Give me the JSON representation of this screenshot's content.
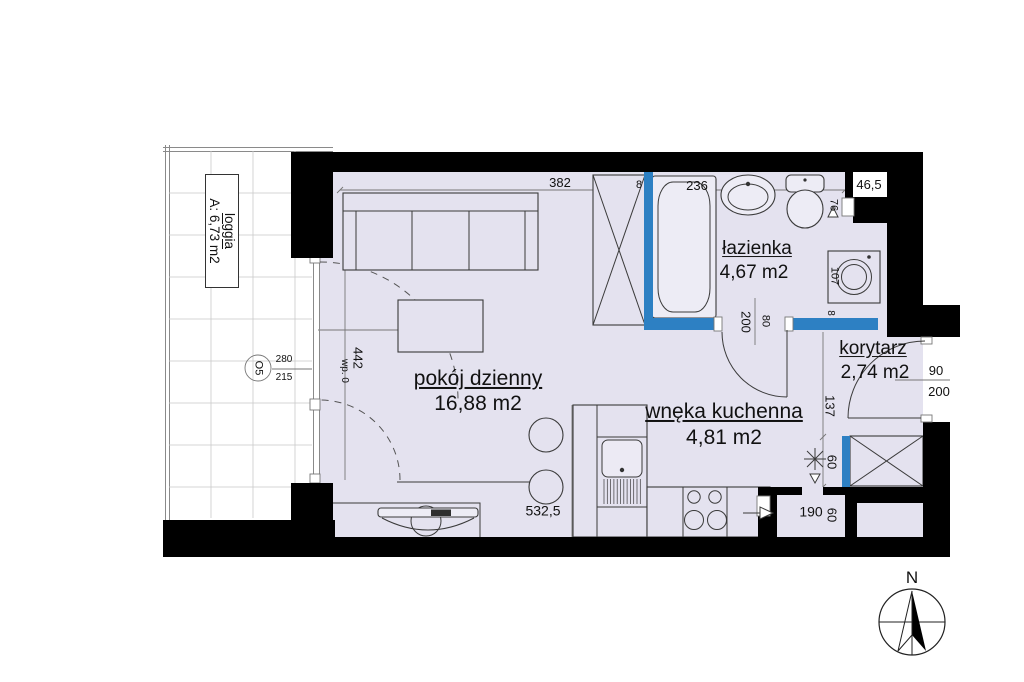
{
  "rooms": {
    "living": {
      "name": "pokój dzienny",
      "area": "16,88 m2"
    },
    "bathroom": {
      "name": "łazienka",
      "area": "4,67 m2"
    },
    "kitchen": {
      "name": "wnęka kuchenna",
      "area": "4,81 m2"
    },
    "corridor": {
      "name": "korytarz",
      "area": "2,74 m2"
    },
    "loggia": {
      "name": "loggia",
      "area": "A: 6,73 m2"
    }
  },
  "dims": {
    "top_382": "382",
    "top_8": "8",
    "top_236": "236",
    "niche_46_5": "46,5",
    "door_76": "76",
    "washer_107": "107",
    "wall_8": "8",
    "bathdoor_200": "200",
    "bathdoor_80": "80",
    "entry_90": "90",
    "entry_200": "200",
    "corridor_137": "137",
    "corridor_60": "60",
    "niche_190": "190",
    "niche_60": "60",
    "bottom_532_5": "532,5",
    "window_442": "442",
    "window_wp0": "wp. 0",
    "window_280": "280",
    "window_215": "215",
    "window_tag_o5": "O5"
  },
  "compass": {
    "north": "N"
  },
  "colors": {
    "wall": "#000000",
    "partition_blue": "#2d80c3",
    "floor": "#e4e2ef"
  }
}
